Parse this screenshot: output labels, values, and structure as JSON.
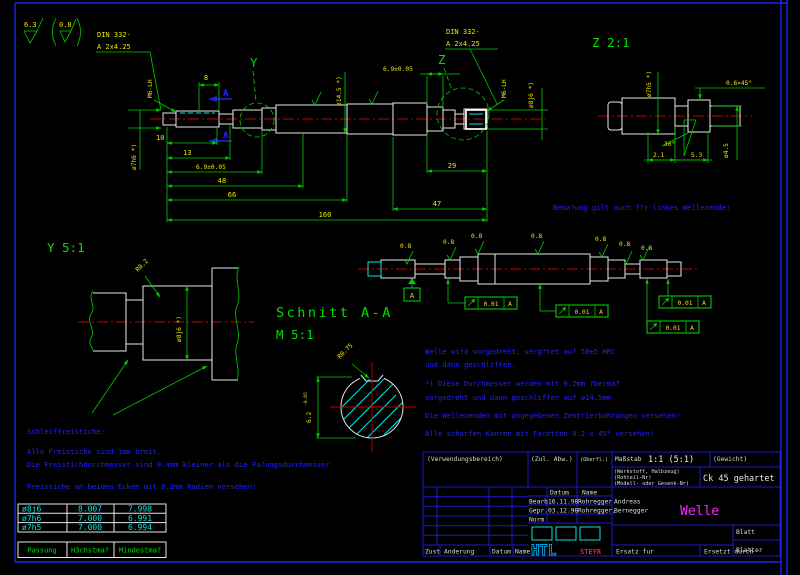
{
  "colors": {
    "line_green": "#00cc00",
    "text_yellow": "#e8e800",
    "outline_white": "#e8e8e8",
    "hatch_cyan": "#00e5e5",
    "note_blue": "#2222ff",
    "frame_blue": "#1a1acc",
    "centerline_red": "#c00000",
    "title_magenta": "#ff22ff",
    "logo_red": "#ee2222",
    "background": "#000000"
  },
  "t": {
    "s63": "6.3",
    "s08": "0.8",
    "din1": "DIN 332-",
    "din2": "A 2x4.25",
    "y": "Y",
    "z": "Z",
    "a": "A",
    "d8": "8",
    "d10": "10",
    "d13": "13",
    "d69": "6.9±0.05",
    "d48": "48",
    "d66": "66",
    "d160": "160",
    "d47": "47",
    "d29": "29",
    "m6": "M6-LH",
    "dia7h6": "ø7h6 *)",
    "dia145": "ø14.5 *)",
    "dia8j6": "ø8j6 *)",
    "ztitle": "Z 2:1",
    "dia7h5": "ø7h5 *)",
    "chamf": "0.6×45°",
    "ang30": "30°",
    "d21": "2.1",
    "d53": "5.3",
    "dia45": "ø4.5",
    "ytitle": "Y 5:1",
    "r02": "R0.2",
    "schnitt": "Schnitt A-A",
    "m51": "M 5:1",
    "r075": "R0.75",
    "d62": "6.2",
    "d62tol": "-0.05",
    "r08": "0.8",
    "datumA": "A",
    "tol": "0.01",
    "note_mirror": "Bema?ung gilt auch f?r linkes Wellenende!"
  },
  "notes_center": [
    "Welle wird vorgedreht, verg?tet auf 50±5 HRC",
    "und dann geschliffen.",
    "*) Diese Durchmesser werden mit 0.2mm ?berma?",
    "vorgedreht und dann geschliffen auf ø14.5mm",
    "Die Wellenenden mit angegebenen Zentrierbohrungen versehen!",
    "Alle scharfen Kanten mit Facetten 0.2 x 45° versehen!"
  ],
  "notes_left": [
    "Schleiffreistiche:",
    "Alle Freistiche sind 1mm breit.",
    "Die Freistichdurchmesser sind 0.4mm kleiner als die Pa?ungsdurchmesser",
    "Freistiche an beiden Ecken mit 0.2mm Radien versehen!"
  ],
  "fit_table": {
    "rows": [
      [
        "ø8j6",
        "8.007",
        "7.998"
      ],
      [
        "ø7h6",
        "7.000",
        "6.991"
      ],
      [
        "ø7h5",
        "7.000",
        "6.994"
      ]
    ],
    "footer": [
      "Passung",
      "H3chstma?",
      "Mindestma?"
    ]
  },
  "tb": {
    "verwendung": "(Verwendungsbereich)",
    "zul": "(Zul. Abw.)",
    "oberfl": "(Oberfl.)",
    "mass_label": "Maßstab",
    "mass_value": "1:1  (5:1)",
    "gewicht": "(Gewicht)",
    "werk1": "(Werkstoff, Halbzeug)",
    "werk2": "(Rohteil-Nr)",
    "werk3": "(Modell- oder Gesenk-Nr)",
    "material": "Ck 45 gehartet",
    "datum": "Datum",
    "name": "Name",
    "bearb": "Bearb.",
    "bearb_date": "16.11.98",
    "bearb_name": "Rohregger",
    "bearb_first": "Andreas",
    "gepr": "Gepr.",
    "gepr_date": "03.12.98",
    "gepr_name": "Rohregger,",
    "gepr_first": "Bernegger",
    "norm": "Norm",
    "title": "Welle",
    "blatt": "Blatt",
    "blaetter": "Blatter",
    "ersatz": "Ersatz fur",
    "ersetzt": "Ersetzt durch",
    "zust": "Zust",
    "aenderung": "Anderung",
    "logo": "HTL",
    "logo_sub": "STEYR"
  }
}
